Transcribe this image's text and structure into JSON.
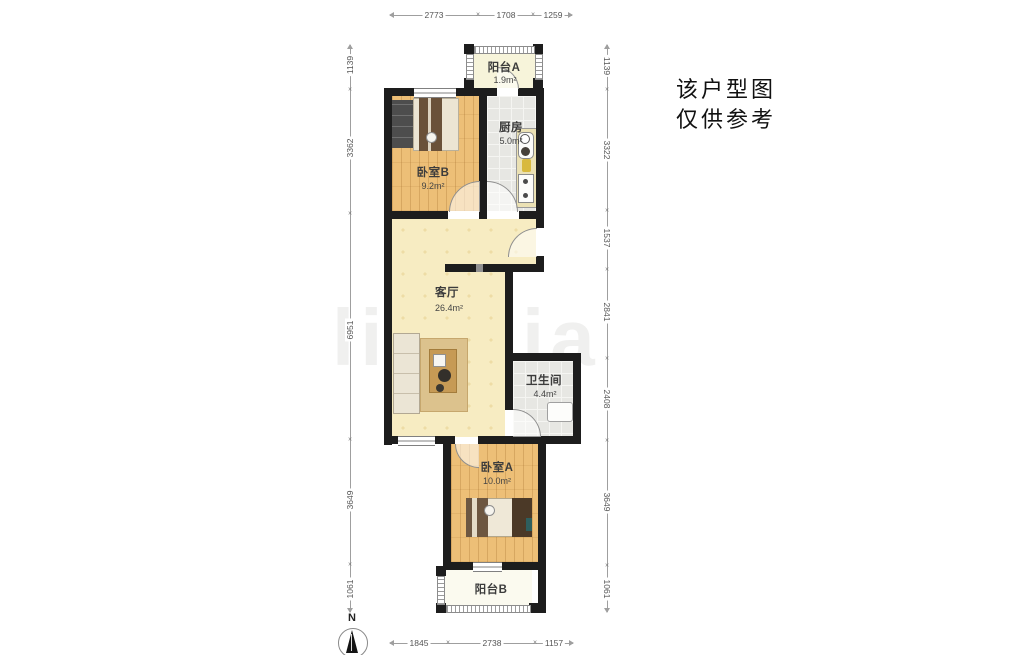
{
  "disclaimer": {
    "line1": "该户型图",
    "line2": "仅供参考"
  },
  "compass": {
    "label": "N"
  },
  "watermark": "lianjia",
  "rooms": {
    "balcony_a": {
      "name": "阳台A",
      "area": "1.9m²"
    },
    "kitchen": {
      "name": "厨房",
      "area": "5.0m²"
    },
    "bedroom_b": {
      "name": "卧室B",
      "area": "9.2m²"
    },
    "living": {
      "name": "客厅",
      "area": "26.4m²"
    },
    "bathroom": {
      "name": "卫生间",
      "area": "4.4m²"
    },
    "bedroom_a": {
      "name": "卧室A",
      "area": "10.0m²"
    },
    "balcony_b": {
      "name": "阳台B"
    }
  },
  "dimensions": {
    "top": [
      "2773",
      "1708",
      "1259"
    ],
    "bottom": [
      "1845",
      "2738",
      "1157"
    ],
    "left": [
      "1139",
      "3362",
      "6951",
      "3649",
      "1061"
    ],
    "right": [
      "1139",
      "3322",
      "1537",
      "2841",
      "2408",
      "3649",
      "1061"
    ]
  },
  "colors": {
    "wall": "#1d1d1d",
    "wood_floor": "#edbf77",
    "living_floor": "#f7ecc2",
    "tile_floor": "#e7e7e3",
    "balcony_floor": "#f7f4da",
    "dimension_line": "#9f9f9f"
  }
}
